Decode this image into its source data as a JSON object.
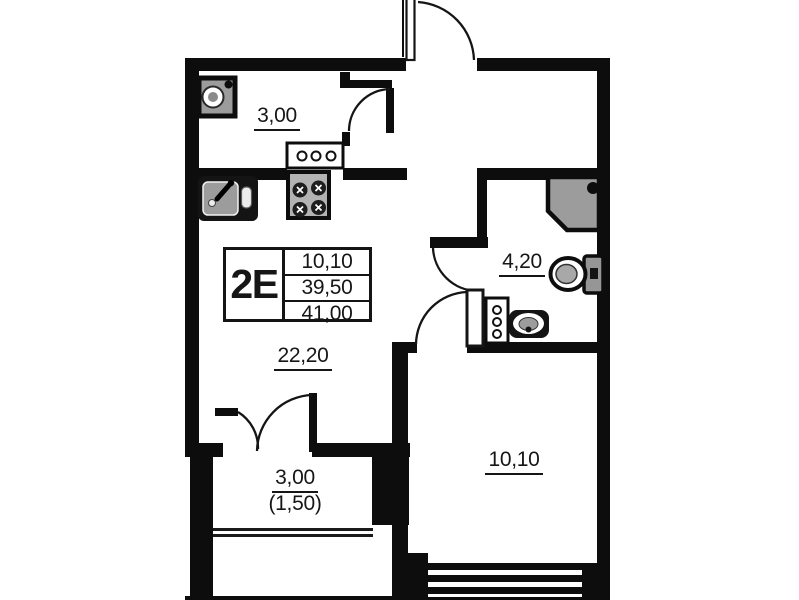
{
  "unit": {
    "label": "2E",
    "area_table": {
      "living_area": "10,10",
      "apartment_area": "39,50",
      "total_area": "41,00"
    }
  },
  "rooms": {
    "hallway": {
      "area": "3,00"
    },
    "kitchen_living": {
      "area": "22,20"
    },
    "bathroom": {
      "area": "4,20"
    },
    "bedroom": {
      "area": "10,10"
    },
    "balcony": {
      "area": "3,00",
      "area_with_coefficient": "(1,50)"
    }
  },
  "colors": {
    "wall": "#0d0d0d",
    "fixture_fill": "#9c9c9c",
    "background": "#ffffff"
  },
  "icons": [
    "entry-door-icon",
    "interior-door-icon",
    "bathroom-door-icon",
    "bedroom-door-icon",
    "balcony-door-icon",
    "washing-machine-icon",
    "kitchen-sink-icon",
    "stove-icon",
    "kitchen-shaft-icon",
    "shower-icon",
    "toilet-icon",
    "washbasin-icon",
    "bathroom-shaft-icon",
    "window-icon",
    "balcony-glazing-icon"
  ]
}
